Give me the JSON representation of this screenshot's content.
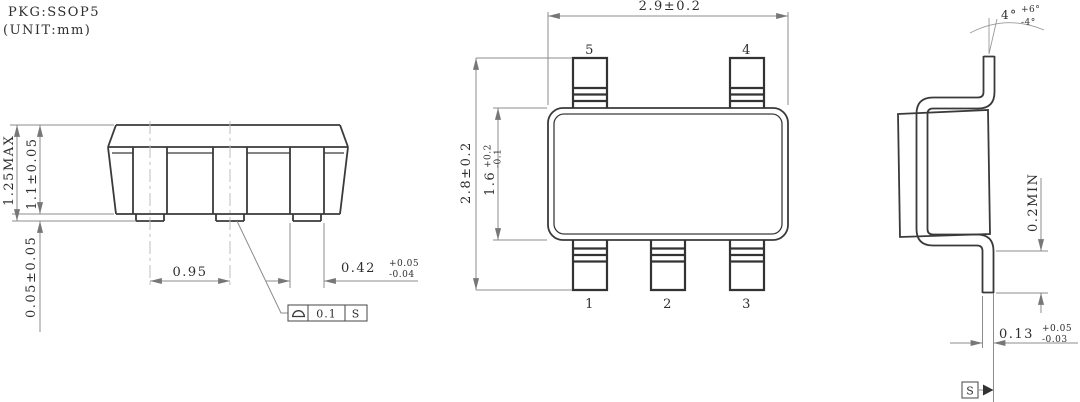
{
  "title_block": {
    "package": "PKG:SSOP5",
    "unit": "(UNIT:mm)"
  },
  "front_view": {
    "overall_height": "1.25MAX",
    "body_height": "1.1±0.05",
    "standoff_height": "0.05±0.05",
    "lead_pitch": "0.95",
    "lead_width": {
      "value": "0.42",
      "plus": "+0.05",
      "minus": "-0.04"
    },
    "coplanarity_frame": {
      "symbol": "seating-plane-coplanarity",
      "tolerance": "0.1",
      "datum": "S"
    }
  },
  "top_view": {
    "overall_width": "2.9±0.2",
    "overall_length": "2.8±0.2",
    "body_length": {
      "value": "1.6",
      "plus": "+0.2",
      "minus": "-0.1"
    },
    "pin_labels": {
      "top": [
        "5",
        "4"
      ],
      "bottom": [
        "1",
        "2",
        "3"
      ]
    }
  },
  "side_view": {
    "lead_angle": {
      "value": "4°",
      "plus": "+6°",
      "minus": "-4°"
    },
    "foot_length": "0.2MIN",
    "lead_thickness": {
      "value": "0.13",
      "plus": "+0.05",
      "minus": "-0.03"
    },
    "seating_datum": "S"
  },
  "colors": {
    "line": "#3a3a3a",
    "dimension": "#8c8c8c",
    "centerline": "#bdbdbd",
    "text": "#2e2e2e",
    "background": "#ffffff"
  }
}
